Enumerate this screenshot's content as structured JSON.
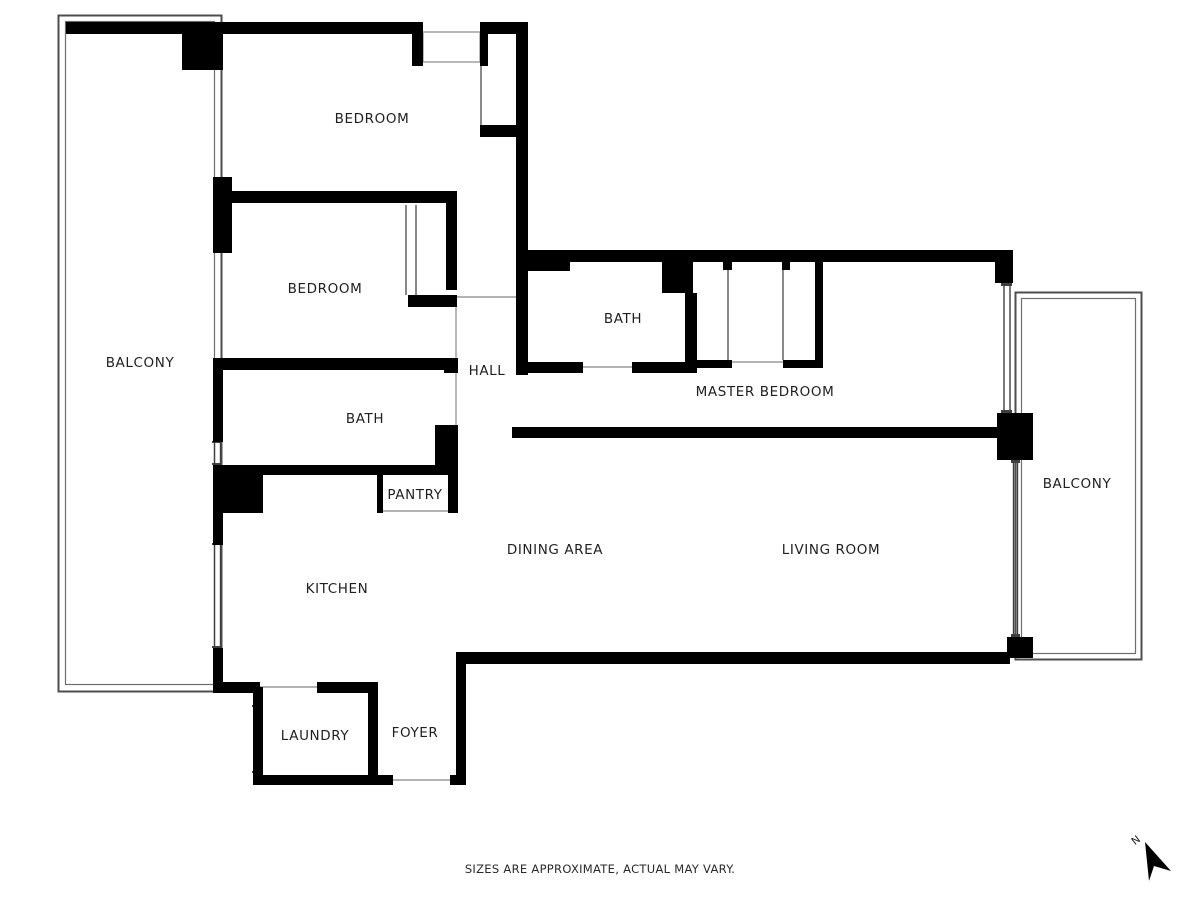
{
  "plan": {
    "rooms": {
      "bedroom_top": "BEDROOM",
      "bedroom_mid": "BEDROOM",
      "balcony_left": "BALCONY",
      "bath_master": "BATH",
      "hall": "HALL",
      "master_bedroom": "MASTER BEDROOM",
      "bath_second": "BATH",
      "pantry": "PANTRY",
      "balcony_right": "BALCONY",
      "dining": "DINING AREA",
      "living": "LIVING ROOM",
      "kitchen": "KITCHEN",
      "laundry": "LAUNDRY",
      "foyer": "FOYER"
    }
  },
  "footer": {
    "disclaimer": "SIZES ARE APPROXIMATE, ACTUAL MAY VARY."
  },
  "compass": {
    "north_label": "N"
  },
  "colors": {
    "wall": "#000000",
    "label": "#1f1f1f",
    "balcony_outline": "#4d4d4d",
    "window_line": "#3f3f3f",
    "door_line": "#9a9a9a",
    "background": "#ffffff"
  }
}
